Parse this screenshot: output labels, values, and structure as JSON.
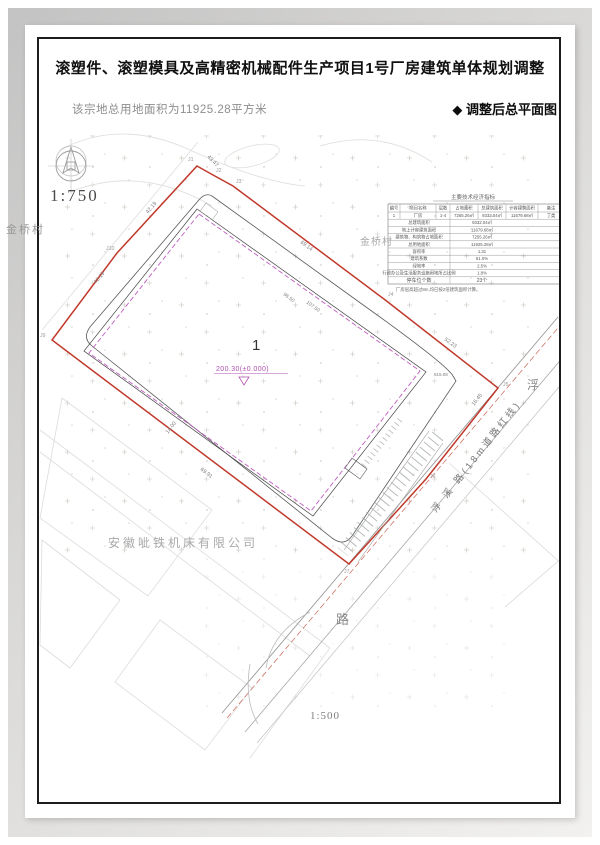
{
  "page": {
    "title": "滚塑件、滚塑模具及高精密机械配件生产项目1号厂房建筑单体规划调整",
    "land_area_note": "该宗地总用地面积为11925.28平方米",
    "drawing_caption": "◆ 调整后总平面图",
    "main_scale": "1:750",
    "road_scale": "1:500"
  },
  "table": {
    "title": "主要技术经济指标",
    "headers": [
      "编号",
      "项目名称",
      "层数",
      "占地面积",
      "总建筑面积",
      "计容建筑面积",
      "备注"
    ],
    "building_row": [
      "1",
      "厂房",
      "1-4",
      "7255.26㎡",
      "9332.04㎡",
      "11679.68㎡",
      "丁类"
    ],
    "summary_rows": [
      {
        "label": "总建筑面积",
        "value": "9332.04㎡"
      },
      {
        "label": "地上计容建筑面积",
        "value": "11679.68㎡"
      },
      {
        "label": "建筑物、构筑物占地面积",
        "value": "7255.26㎡"
      },
      {
        "label": "总用地面积",
        "value": "11925.28㎡"
      },
      {
        "label": "容积率",
        "value": "1.31"
      },
      {
        "label": "建筑系数",
        "value": "61.0%"
      },
      {
        "label": "绿地率",
        "value": "2.5%"
      },
      {
        "label": "行政办公及生活服务设施用地所占比例",
        "value": "1.8%"
      },
      {
        "label": "停车位个数",
        "value": "23个"
      }
    ],
    "note": "厂房层高超过8m,均已按2倍建筑面积计算。"
  },
  "plan": {
    "building_number": "1",
    "elevation_mark": "200.30(±0.000)",
    "village_label": "金桥村",
    "village_label_2": "金桥村",
    "company_label": "安徽呲铁机床有限公司",
    "road_name": "浮 溪 路(18m道路红线)",
    "road_char_top": "浮",
    "road_char_bottom": "路",
    "boundary_points": [
      "J1",
      "J2",
      "J3",
      "J4",
      "J5",
      "J6",
      "J7",
      "J9",
      "J10"
    ],
    "dimensions": [
      "43.47",
      "69.14",
      "52.23",
      "42.19",
      "42.19",
      "69.91",
      "14.00",
      "16.45",
      "815.08",
      "96.50",
      "107.50"
    ]
  },
  "colors": {
    "boundary_red": "#c0392b",
    "building_magenta": "#c05ec0",
    "road_redline": "#cc6655",
    "ink": "#1a1a1a"
  }
}
